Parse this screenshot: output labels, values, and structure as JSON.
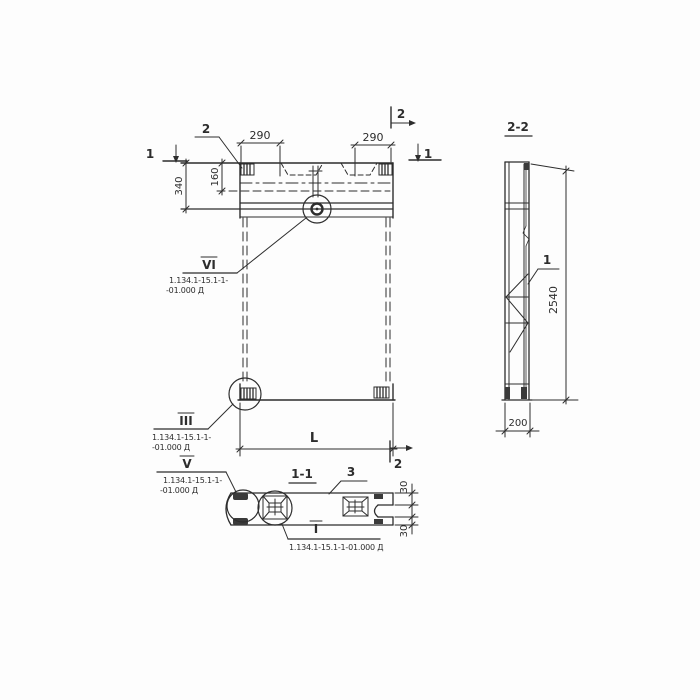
{
  "front": {
    "dim_290_left": "290",
    "dim_290_right": "290",
    "dim_340": "340",
    "dim_160": "160",
    "dim_length_label": "L",
    "callout_2_label": "2",
    "section_mark_1_left": "1",
    "section_mark_1_right": "1",
    "section_mark_2_top": "2",
    "section_mark_2_bottom": "2"
  },
  "section_1_1": {
    "title": "1-1",
    "callout_3_label": "3",
    "dim_30_top": "30",
    "dim_30_bottom": "30"
  },
  "section_2_2": {
    "title": "2-2",
    "dim_height": "2540",
    "dim_width": "200",
    "callout_1_label": "1"
  },
  "flags": {
    "vi": {
      "numeral": "VI",
      "ref_line1": "1.134.1-15.1-1-",
      "ref_line2": "-01.000 Д"
    },
    "iii": {
      "numeral": "III",
      "ref_line1": "1.134.1-15.1-1-",
      "ref_line2": "-01.000 Д"
    },
    "v": {
      "numeral": "V",
      "ref_line1": "1.134.1-15.1-1-",
      "ref_line2": "-01.000 Д"
    },
    "i": {
      "numeral": "I",
      "ref_line": "1.134.1-15.1-1-01.000 Д"
    }
  },
  "colors": {
    "ink": "#2d2d2d",
    "paper": "#fdfdfd"
  }
}
